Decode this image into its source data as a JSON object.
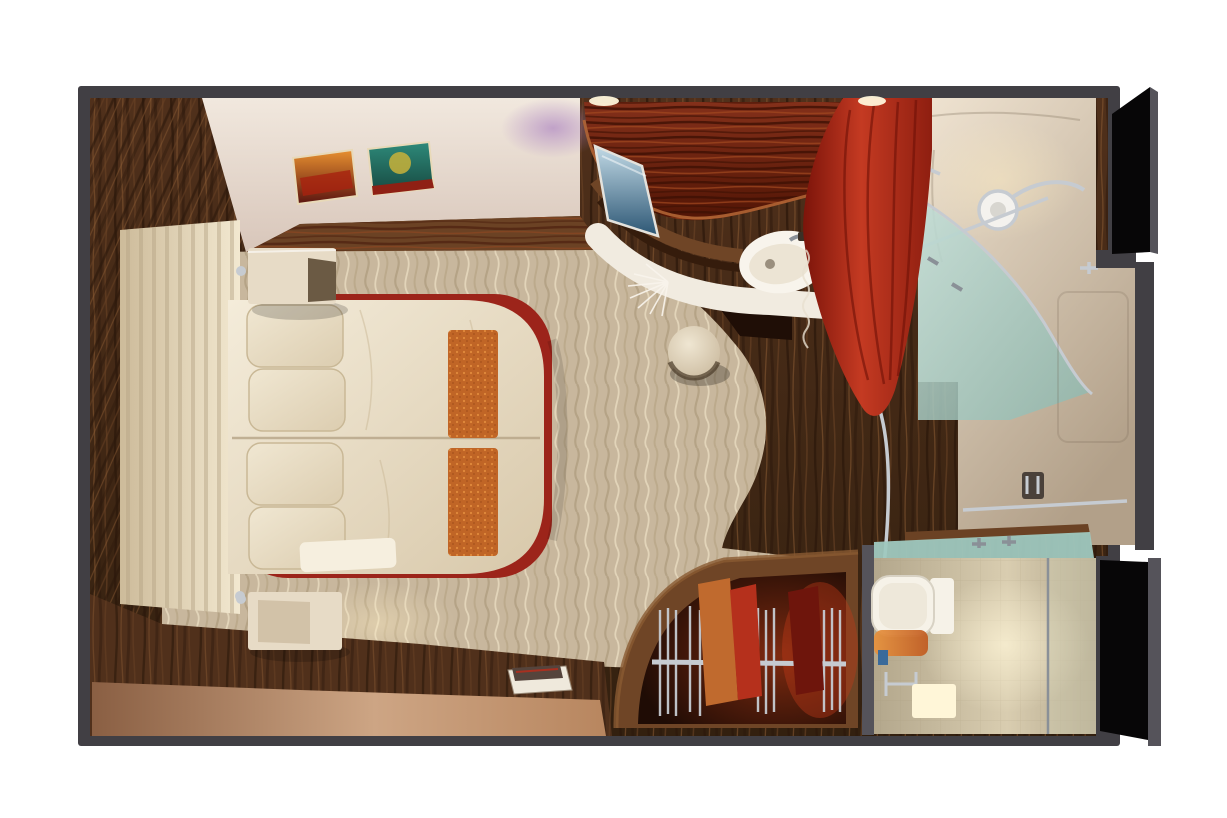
{
  "scene": {
    "description": "Photorealistic 3D top-down cutaway render of a cruise-ship stateroom on a white background",
    "view": "overhead dollhouse / floor-plan perspective",
    "rooms": [
      {
        "name": "bedroom",
        "items": [
          "panelled-headboard",
          "double-bed-two-mattresses",
          "four-pillows",
          "two-orange-bed-runners",
          "red-bed-base",
          "floating-nightstand-top",
          "floating-nightstand-bottom",
          "chrome-reading-lamps",
          "framed-art-sunset",
          "framed-art-teal",
          "book-on-floor",
          "wavy-beige-carpet",
          "zebra-wood-walls"
        ]
      },
      {
        "name": "vanity-lounge",
        "items": [
          "curved-mahogany-canopy",
          "flat-screen-tv",
          "white-curved-counter",
          "washbasin-with-faucet",
          "white-feather-plant",
          "round-cream-stool",
          "dark-wood-floor"
        ]
      },
      {
        "name": "wardrobe",
        "items": [
          "curved-open-closet",
          "chrome-clothes-rail",
          "hangers",
          "orange-garment",
          "red-garment",
          "dark-red-garment"
        ]
      },
      {
        "name": "shower-room",
        "items": [
          "red-shower-curtain",
          "curved-frosted-glass-screen",
          "rain-shower-head",
          "chrome-grab-rails",
          "towel-bar",
          "door-handle",
          "beige-walls"
        ]
      },
      {
        "name": "wc-cubicle",
        "items": [
          "toilet-with-cistern",
          "frosted-teal-partition",
          "counter-faucets",
          "amber-niche",
          "towel-rail",
          "glowing-cube-light"
        ]
      }
    ],
    "openings": [
      "open-entry-door-top-right",
      "dark-doorway-bottom-right"
    ]
  },
  "palette": {
    "bg": "#ffffff",
    "wall": "#413f44",
    "wall_light": "#55535a",
    "wood_base": "#50301b",
    "wood_dark_line": "#2c180b",
    "wood_mid_line": "#6b4224",
    "wood_light_line": "#8a5a32",
    "ceiling_a": "#f1e8de",
    "ceiling_b": "#d8c6ba",
    "purple_glow": "#a97fc0",
    "warm_light": "#ffeec2",
    "carpet": "#c8b79d",
    "carpet_wave_dark": "#a18f70",
    "carpet_wave_mid": "#b4a281",
    "carpet_wave_light": "#e6dabf",
    "headboard_a": "#cdbb9a",
    "headboard_b": "#f2e8d0",
    "slat_shadow": "#b3a284",
    "duvet_a": "#f4ecda",
    "duvet_b": "#d8c8aa",
    "pillow_a": "#f0e7d2",
    "pillow_b": "#dccdb0",
    "pillow_edge": "#c9b896",
    "runner": "#c06526",
    "runner_dot": "#e6913f",
    "bed_red": "#9c241a",
    "nightstand": "#e7dbc6",
    "nightstand_face": "#d2c2a8",
    "nightstand_dark": "#6b5a44",
    "canopy_a": "#84301a",
    "canopy_b": "#521505",
    "canopy_stripe_dark": "#3e1004",
    "canopy_stripe_light": "#a3491f",
    "canopy_rim": "#b06434",
    "tv_a": "#c2dae6",
    "tv_b": "#2c5674",
    "tv_frame": "#e4e2dc",
    "counter_white": "#f1ebe0",
    "sink_white": "#f8f4ec",
    "sink_inner": "#ece4d4",
    "chrome": "#c6cbd1",
    "chrome_dark": "#8a9097",
    "curtain_a": "#7c140a",
    "curtain_b": "#c43a22",
    "curtain_c": "#8e1e10",
    "glass_a": "#c2ddd6",
    "glass_b": "#8db8af",
    "bath_wall_a": "#f0e4d2",
    "bath_wall_b": "#b2a089",
    "door_beige": "#cdb89f",
    "floor_tan_a": "#8a5f43",
    "floor_tan_b": "#cda584",
    "closet_wood": "#6f4526",
    "closet_int_a": "#7e2a10",
    "closet_int_b": "#1f0c05",
    "garment_orange": "#c06a2e",
    "garment_red": "#b5301c",
    "garment_dark": "#6e150c",
    "teal_band": "#9fc8bf",
    "toilet_white": "#f6f2e8",
    "wc_wall_a": "#d9cdb0",
    "wc_wall_b": "#b3a78c",
    "niche_a": "#e8923c",
    "niche_b": "#c05a20",
    "cube_glow": "#fff6d8",
    "black_opening": "#070607",
    "art1_a": "#e89030",
    "art1_b": "#5a1410",
    "art2_a": "#2e8a7a",
    "art2_b": "#8f2014",
    "stool_a": "#efe6d2",
    "stool_b": "#c9b89c",
    "book_pages": "#efe9dc",
    "book_cover": "#55443c"
  }
}
